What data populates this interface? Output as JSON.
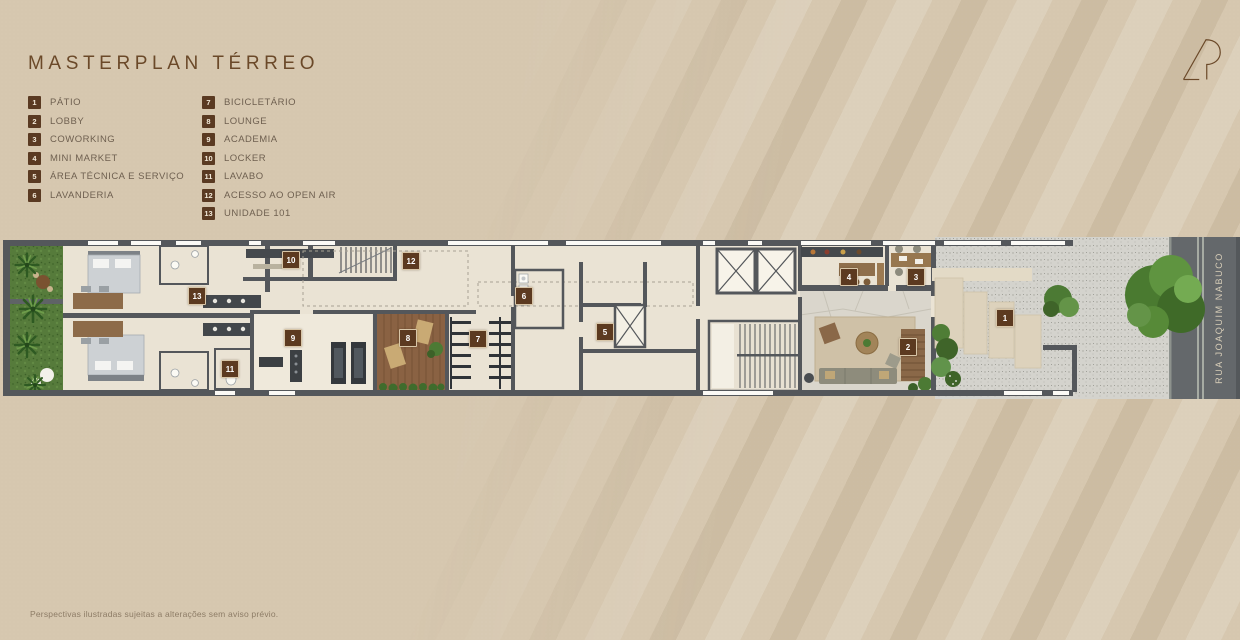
{
  "page": {
    "title": "MASTERPLAN TÉRREO",
    "disclaimer": "Perspectivas ilustradas sujeitas a alterações sem aviso prévio.",
    "logo_monogram": "R"
  },
  "legend": {
    "items": [
      {
        "num": "1",
        "label": "PÁTIO"
      },
      {
        "num": "2",
        "label": "LOBBY"
      },
      {
        "num": "3",
        "label": "COWORKING"
      },
      {
        "num": "4",
        "label": "MINI MARKET"
      },
      {
        "num": "5",
        "label": "ÁREA TÉCNICA E SERVIÇO"
      },
      {
        "num": "6",
        "label": "LAVANDERIA"
      },
      {
        "num": "7",
        "label": "BICICLETÁRIO"
      },
      {
        "num": "8",
        "label": "LOUNGE"
      },
      {
        "num": "9",
        "label": "ACADEMIA"
      },
      {
        "num": "10",
        "label": "LOCKER"
      },
      {
        "num": "11",
        "label": "LAVABO"
      },
      {
        "num": "12",
        "label": "ACESSO AO OPEN AIR"
      },
      {
        "num": "13",
        "label": "UNIDADE 101"
      }
    ]
  },
  "plan": {
    "street_name": "RUA JOAQUIM NABUCO",
    "markers": [
      {
        "num": "1",
        "x": 1005,
        "y": 318
      },
      {
        "num": "2",
        "x": 908,
        "y": 347
      },
      {
        "num": "3",
        "x": 916,
        "y": 277
      },
      {
        "num": "4",
        "x": 849,
        "y": 277
      },
      {
        "num": "5",
        "x": 605,
        "y": 332
      },
      {
        "num": "6",
        "x": 524,
        "y": 296
      },
      {
        "num": "7",
        "x": 478,
        "y": 339
      },
      {
        "num": "8",
        "x": 408,
        "y": 338
      },
      {
        "num": "9",
        "x": 293,
        "y": 338
      },
      {
        "num": "10",
        "x": 291,
        "y": 260
      },
      {
        "num": "11",
        "x": 230,
        "y": 369
      },
      {
        "num": "12",
        "x": 411,
        "y": 261
      },
      {
        "num": "13",
        "x": 197,
        "y": 296
      }
    ]
  },
  "colors": {
    "background": "#d6c7af",
    "accent_brown": "#5c3a20",
    "title_brown": "#6b4929",
    "wall_gray": "#54575b",
    "street_gray": "#64686b"
  }
}
